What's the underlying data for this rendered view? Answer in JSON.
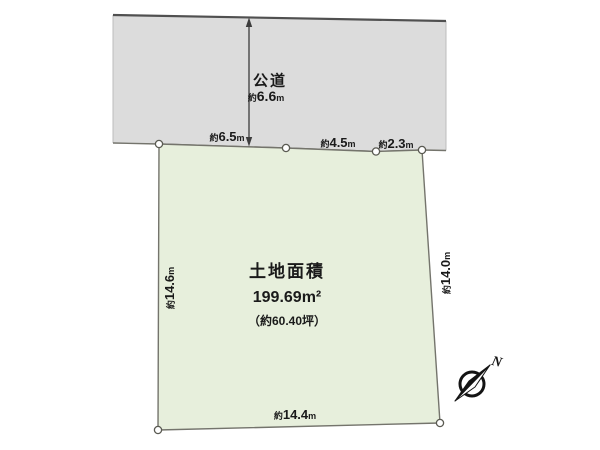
{
  "road": {
    "name": "公道",
    "width": {
      "approx": "約",
      "value": "6.6",
      "unit": "m"
    }
  },
  "plot": {
    "title": "土地面積",
    "area_m2": "199.69m²",
    "area_tsubo": "（約60.40坪）"
  },
  "dimensions": {
    "top_left": {
      "approx": "約",
      "value": "6.5",
      "unit": "m"
    },
    "top_middle": {
      "approx": "約",
      "value": "4.5",
      "unit": "m"
    },
    "top_right": {
      "approx": "約",
      "value": "2.3",
      "unit": "m"
    },
    "left": {
      "approx": "約",
      "value": "14.6",
      "unit": "m"
    },
    "right": {
      "approx": "約",
      "value": "14.0",
      "unit": "m"
    },
    "bottom": {
      "approx": "約",
      "value": "14.4",
      "unit": "m"
    }
  },
  "compass": {
    "north_label": "N"
  },
  "colors": {
    "road_fill": "#dcdcdc",
    "plot_fill": "#e7efdc",
    "edge_line": "#74746c",
    "road_top_edge": "#505050",
    "text": "#1a1a1a"
  }
}
